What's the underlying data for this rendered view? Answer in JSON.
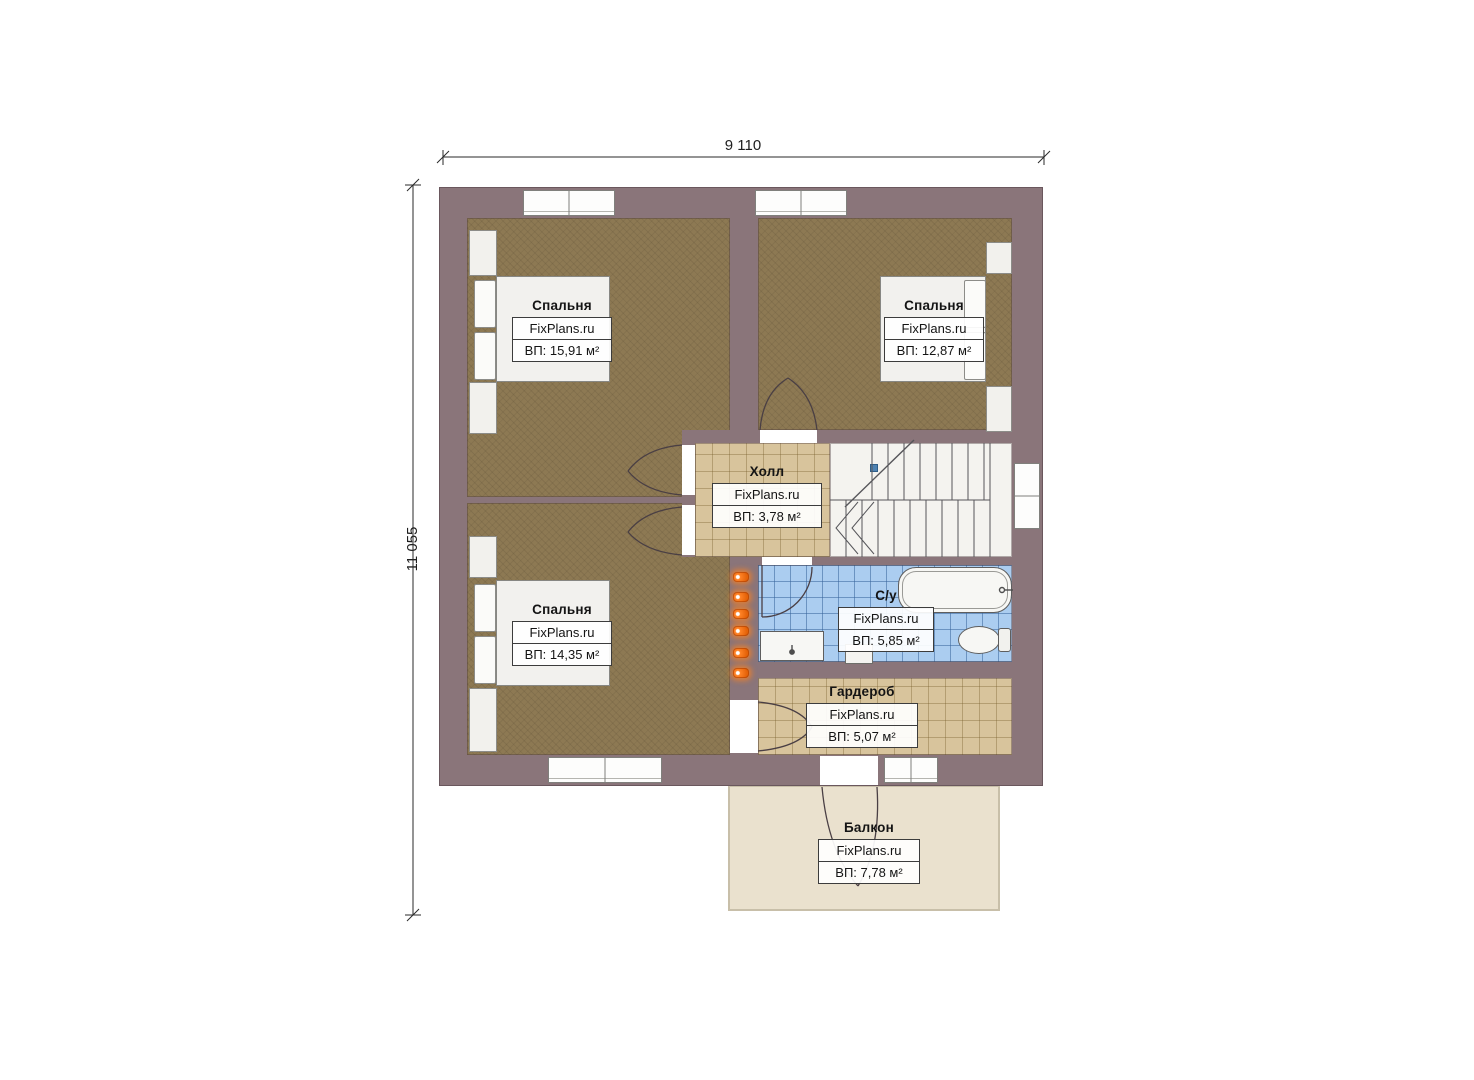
{
  "plan": {
    "type": "floor-plan-second-storey",
    "background": "#ffffff"
  },
  "dimensions": {
    "top": "9 110",
    "left": "11 055"
  },
  "brand": "FixPlans.ru",
  "rooms": [
    {
      "id": "bedroom-top-left",
      "name": "Спальня",
      "brand": "FixPlans.ru",
      "area": "ВП: 15,91 м²"
    },
    {
      "id": "bedroom-top-right",
      "name": "Спальня",
      "brand": "FixPlans.ru",
      "area": "ВП: 12,87 м²"
    },
    {
      "id": "bedroom-bottom-left",
      "name": "Спальня",
      "brand": "FixPlans.ru",
      "area": "ВП: 14,35 м²"
    },
    {
      "id": "hall",
      "name": "Холл",
      "brand": "FixPlans.ru",
      "area": "ВП: 3,78 м²"
    },
    {
      "id": "bathroom",
      "name": "С/у",
      "brand": "FixPlans.ru",
      "area": "ВП: 5,85 м²"
    },
    {
      "id": "wardrobe",
      "name": "Гардероб",
      "brand": "FixPlans.ru",
      "area": "ВП: 5,07 м²"
    },
    {
      "id": "balcony",
      "name": "Балкон",
      "brand": "FixPlans.ru",
      "area": "ВП: 7,78 м²"
    }
  ],
  "palette": {
    "wall": "#8a757a",
    "bedroom_floor": "#8d7953",
    "tile_floor": "#d8c49c",
    "bathroom_floor": "#abcdf0",
    "stairs_floor": "#f4f3ef",
    "balcony_floor": "#eae1ce",
    "socket_accent": "#f07820",
    "stair_handle": "#4d82b2"
  },
  "icons": {
    "sockets_count": 6,
    "socket_icon": "power-socket",
    "stair_handle_icon": "stair-break-handle"
  }
}
